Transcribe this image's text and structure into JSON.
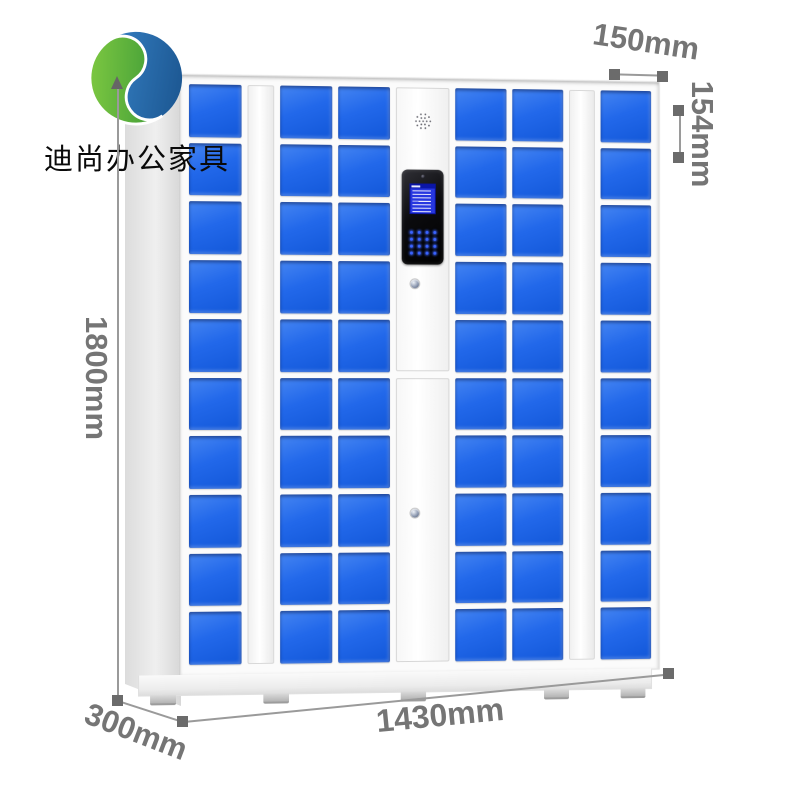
{
  "brand": {
    "name": "迪尚办公家具",
    "logo_icon": "green-blue-s-swirl"
  },
  "dimensions": {
    "height_label": "1800mm",
    "width_label": "1430mm",
    "depth_label": "300mm",
    "top_depth_label": "150mm",
    "cell_height_label": "154mm"
  },
  "colors": {
    "door_blue": "#2268ea",
    "dimension_gray": "#757575",
    "logo_green": "#3f9c35",
    "logo_blue": "#1e5f9e",
    "lcd_blue": "#2737e0"
  },
  "locker": {
    "rows": 10,
    "keypad": {
      "rows": 4,
      "cols": 4
    },
    "columns": [
      {
        "type": "doors",
        "name": "door-column-1"
      },
      {
        "type": "divider",
        "name": "divider-left"
      },
      {
        "type": "doors",
        "name": "door-column-2"
      },
      {
        "type": "doors",
        "name": "door-column-3"
      },
      {
        "type": "control",
        "name": "control-column"
      },
      {
        "type": "doors",
        "name": "door-column-4"
      },
      {
        "type": "doors",
        "name": "door-column-5"
      },
      {
        "type": "divider",
        "name": "divider-right"
      },
      {
        "type": "doors",
        "name": "door-column-6"
      }
    ]
  }
}
